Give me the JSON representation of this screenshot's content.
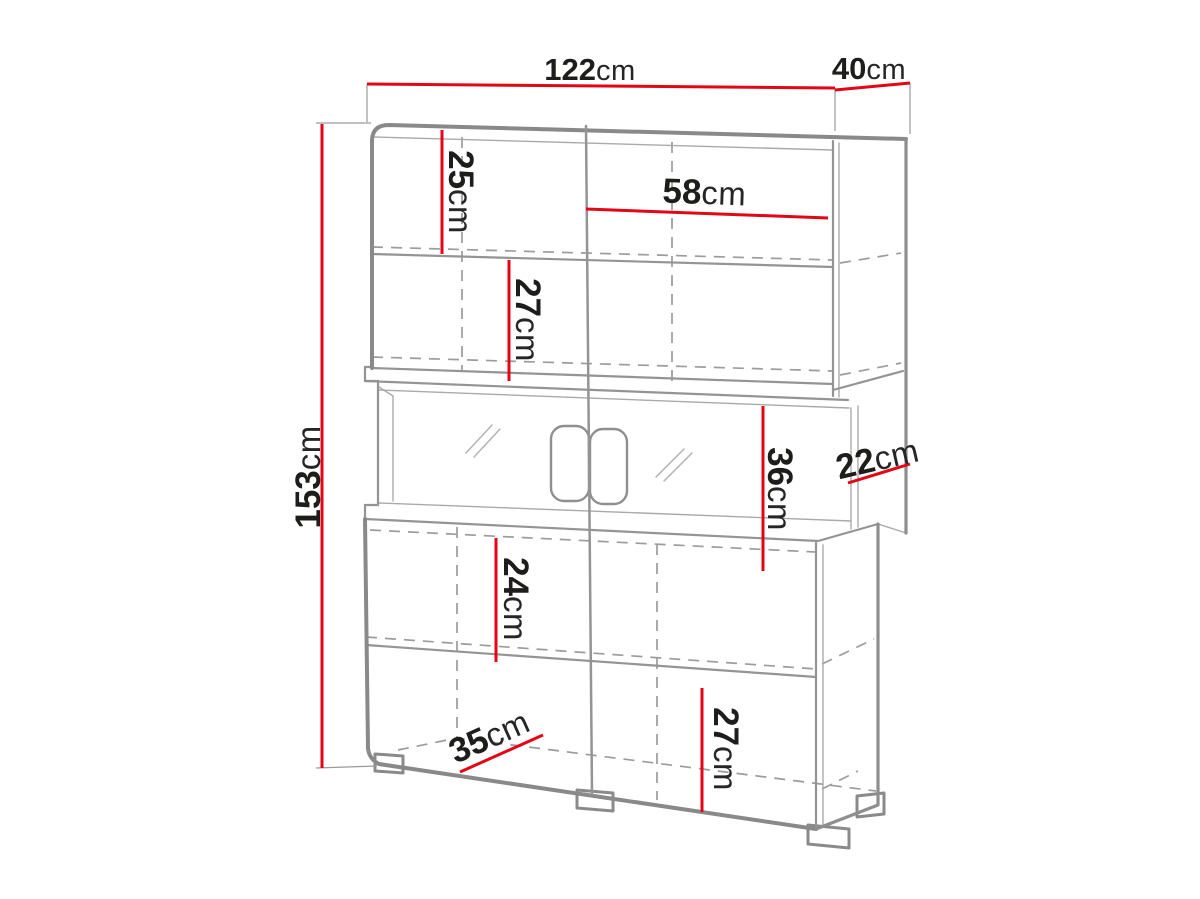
{
  "diagram": {
    "subject": "Display cabinet dimensioned line drawing",
    "unit": "cm",
    "colors": {
      "dimension_line": "#e30615",
      "outline_gray": "#8a8a8a",
      "label_text": "#1d1d1b",
      "background": "#ffffff"
    },
    "dimensions": {
      "top_width": {
        "value": "122",
        "unit": "cm"
      },
      "top_depth": {
        "value": "40",
        "unit": "cm"
      },
      "total_height": {
        "value": "153",
        "unit": "cm"
      },
      "upper_compartment": {
        "value": "25",
        "unit": "cm"
      },
      "upper_shelf_width": {
        "value": "58",
        "unit": "cm"
      },
      "second_compartment": {
        "value": "27",
        "unit": "cm"
      },
      "middle_opening": {
        "value": "36",
        "unit": "cm"
      },
      "middle_depth": {
        "value": "22",
        "unit": "cm"
      },
      "lower_compartment": {
        "value": "24",
        "unit": "cm"
      },
      "bottom_depth": {
        "value": "35",
        "unit": "cm"
      },
      "bottom_compartment": {
        "value": "27",
        "unit": "cm"
      }
    }
  }
}
